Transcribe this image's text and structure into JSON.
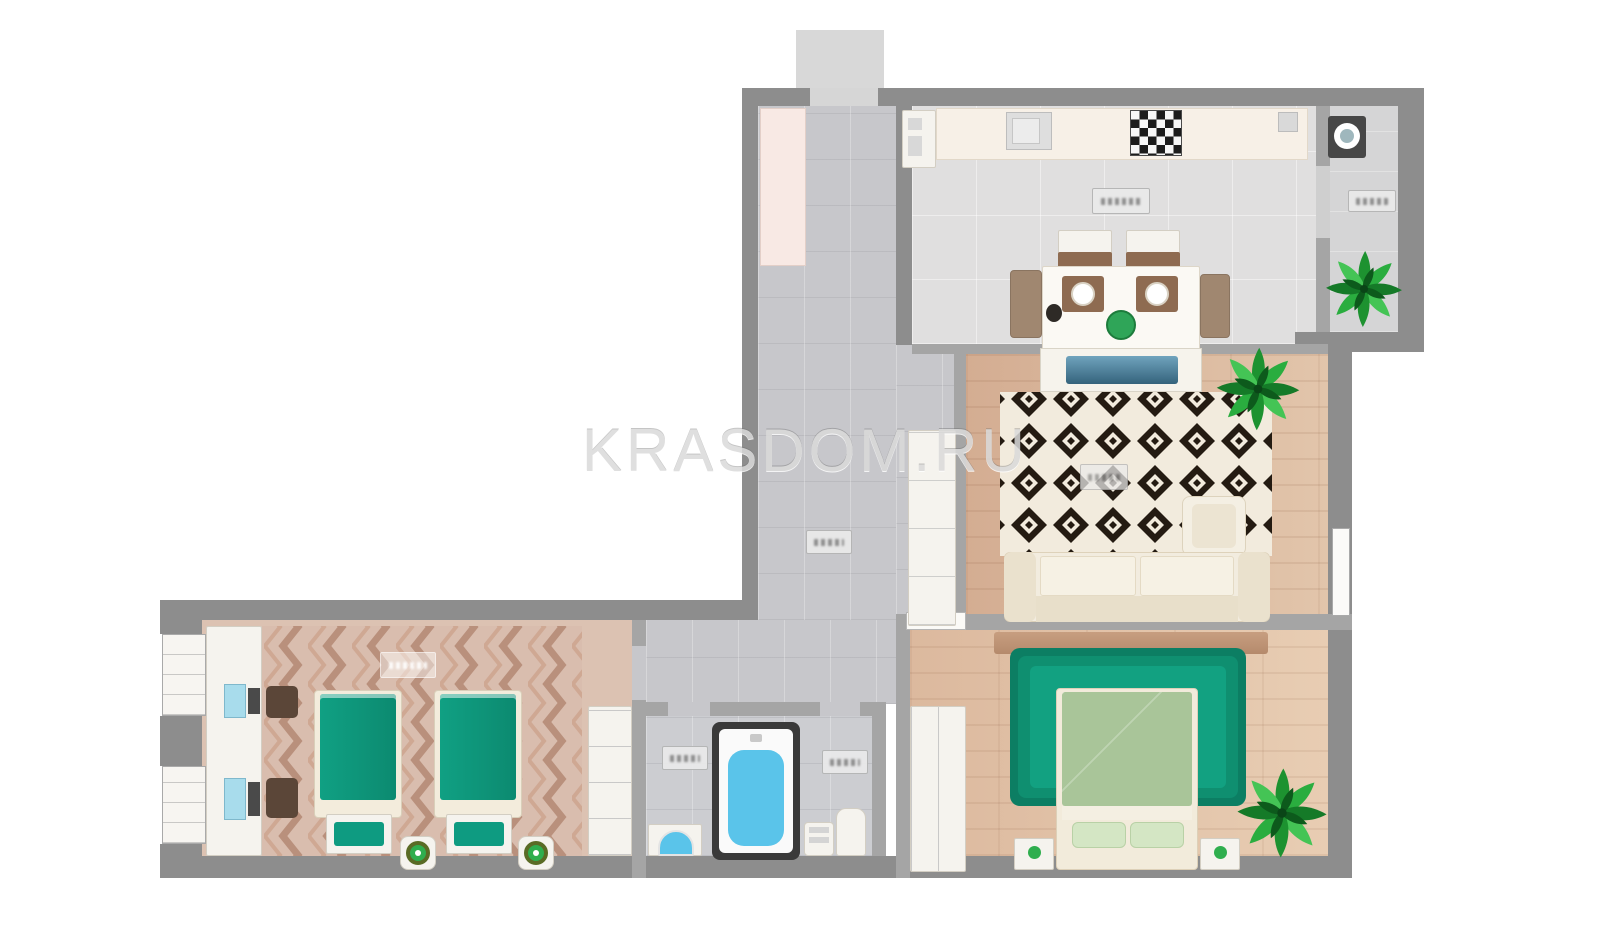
{
  "watermark": {
    "text": "KRASDOM.RU"
  },
  "plan": {
    "type": "apartment-floor-plan",
    "rooms": [
      "entry-hallway",
      "kitchen-dining",
      "balcony",
      "living-room",
      "master-bedroom",
      "kids-bedroom",
      "bathroom",
      "wc-zone"
    ],
    "furniture": [
      "entry-closet",
      "fridge",
      "kitchen-counter",
      "kitchen-sink",
      "stove-cooktop",
      "dining-table",
      "dining-chairs",
      "tv-console",
      "washing-machine",
      "potted-plant",
      "diamond-rug",
      "sofa",
      "armchair",
      "hall-cabinet",
      "emerald-rug",
      "double-bed",
      "nightstand",
      "dresser",
      "wardrobe",
      "twin-bed",
      "bench-box",
      "stool",
      "desk-console",
      "bathtub",
      "washbasin",
      "toilet",
      "water-heater",
      "window"
    ],
    "area_labels": {
      "count": 7,
      "legible": false
    }
  },
  "palette": {
    "wall": "#8d8d8d",
    "inner_wall": "#a5a5a5",
    "concrete_floor": "#c7c7cb",
    "kitchen_floor": "#e0dfdf",
    "wood_floor": "#d4ad92",
    "kids_floor": "#dcc2b2",
    "counter_cream": "#f7f0e7",
    "teal_bed": "#0e9b81",
    "emerald_rug": "#0c7e63",
    "sage_duvet": "#a9c599",
    "water_blue": "#5ac4ea",
    "plant_green": "#1d9230",
    "rug_black": "#241b12",
    "rug_cream": "#f2ebdd",
    "stool_green": "#2fae4e",
    "entry_closet_pink": "#f8e9e4"
  }
}
